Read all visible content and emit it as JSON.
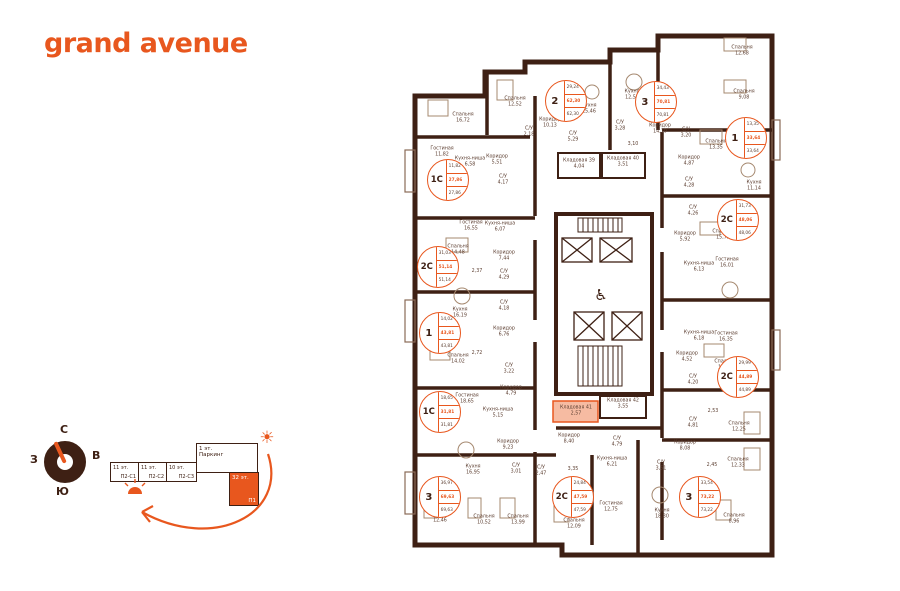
{
  "logo": {
    "text": "grand avenue"
  },
  "colors": {
    "accent": "#E8571E",
    "wall": "#3E2014",
    "room_text": "#5E4033",
    "storage_highlight": "#F6BBA2"
  },
  "compass": {
    "north": "С",
    "east": "В",
    "west": "З",
    "south": "Ю"
  },
  "section_diagram": {
    "blocks": [
      {
        "floors": "11 эт.",
        "name": "П2-С1"
      },
      {
        "floors": "11 эт.",
        "name": "П2-С2"
      },
      {
        "floors": "10 эт.",
        "name": "П2-С3"
      }
    ],
    "parking": {
      "floors": "1 эт.",
      "name": "Паркинг"
    },
    "current": {
      "floors": "32 эт.",
      "name": "П1"
    }
  },
  "plan": {
    "badges": [
      {
        "type": "1С",
        "x": 448,
        "y": 180,
        "values": [
          "11,82",
          "27,86",
          "27,86"
        ]
      },
      {
        "type": "2",
        "x": 566,
        "y": 101,
        "values": [
          "29,24",
          "62,30",
          "62,30"
        ]
      },
      {
        "type": "3",
        "x": 656,
        "y": 102,
        "values": [
          "34,43",
          "70,81",
          "70,81"
        ]
      },
      {
        "type": "1",
        "x": 746,
        "y": 138,
        "values": [
          "13,35",
          "33,64",
          "33,64"
        ]
      },
      {
        "type": "2С",
        "x": 738,
        "y": 220,
        "values": [
          "31,73",
          "48,06",
          "48,06"
        ]
      },
      {
        "type": "2С",
        "x": 438,
        "y": 267,
        "values": [
          "31,03",
          "51,14",
          "51,14"
        ]
      },
      {
        "type": "1",
        "x": 440,
        "y": 333,
        "values": [
          "14,02",
          "43,81",
          "43,81"
        ]
      },
      {
        "type": "2С",
        "x": 738,
        "y": 377,
        "values": [
          "29,99",
          "44,89",
          "44,89"
        ]
      },
      {
        "type": "1С",
        "x": 440,
        "y": 412,
        "values": [
          "18,65",
          "31,81",
          "31,81"
        ]
      },
      {
        "type": "3",
        "x": 440,
        "y": 497,
        "values": [
          "36,97",
          "69,63",
          "69,63"
        ]
      },
      {
        "type": "2С",
        "x": 573,
        "y": 497,
        "values": [
          "24,84",
          "47,59",
          "47,59"
        ]
      },
      {
        "type": "3",
        "x": 700,
        "y": 497,
        "values": [
          "33,54",
          "73,22",
          "73,22"
        ]
      }
    ],
    "rooms": [
      {
        "label": "Спальня",
        "area": "16,72",
        "x": 463,
        "y": 119
      },
      {
        "label": "Спальня",
        "area": "12,52",
        "x": 515,
        "y": 103
      },
      {
        "label": "Гостиная",
        "area": "11,82",
        "x": 442,
        "y": 153
      },
      {
        "label": "Кухня-ниша",
        "area": "6,58",
        "x": 470,
        "y": 163
      },
      {
        "label": "Коридор",
        "area": "5,51",
        "x": 497,
        "y": 161
      },
      {
        "label": "С/У",
        "area": "4,17",
        "x": 503,
        "y": 181
      },
      {
        "label": "Гостиная",
        "area": "16,55",
        "x": 471,
        "y": 227
      },
      {
        "label": "Кухня-ниша",
        "area": "6,07",
        "x": 500,
        "y": 228
      },
      {
        "label": "Спальня",
        "area": "14,48",
        "x": 458,
        "y": 251
      },
      {
        "label": "Коридор",
        "area": "7,44",
        "x": 504,
        "y": 257
      },
      {
        "label": "",
        "area": "2,37",
        "x": 477,
        "y": 272
      },
      {
        "label": "С/У",
        "area": "4,29",
        "x": 504,
        "y": 276
      },
      {
        "label": "С/У",
        "area": "4,18",
        "x": 504,
        "y": 307
      },
      {
        "label": "Кухня",
        "area": "16,19",
        "x": 460,
        "y": 314
      },
      {
        "label": "Коридор",
        "area": "6,76",
        "x": 504,
        "y": 333
      },
      {
        "label": "Спальня",
        "area": "14,02",
        "x": 458,
        "y": 360
      },
      {
        "label": "",
        "area": "2,72",
        "x": 477,
        "y": 354
      },
      {
        "label": "С/У",
        "area": "3,22",
        "x": 509,
        "y": 370
      },
      {
        "label": "Коридор",
        "area": "4,79",
        "x": 511,
        "y": 392
      },
      {
        "label": "Гостиная",
        "area": "18,65",
        "x": 467,
        "y": 400
      },
      {
        "label": "Кухня-ниша",
        "area": "5,15",
        "x": 498,
        "y": 414
      },
      {
        "label": "Коридор",
        "area": "9,23",
        "x": 508,
        "y": 446
      },
      {
        "label": "Кухня",
        "area": "16,95",
        "x": 473,
        "y": 471
      },
      {
        "label": "С/У",
        "area": "3,01",
        "x": 516,
        "y": 470
      },
      {
        "label": "С/У",
        "area": "2,47",
        "x": 541,
        "y": 472
      },
      {
        "label": "",
        "area": "3,35",
        "x": 573,
        "y": 470
      },
      {
        "label": "Спальня",
        "area": "12,46",
        "x": 440,
        "y": 519
      },
      {
        "label": "Спальня",
        "area": "10,52",
        "x": 484,
        "y": 521
      },
      {
        "label": "Спальня",
        "area": "13,99",
        "x": 518,
        "y": 521
      },
      {
        "label": "Кухня",
        "area": "15,46",
        "x": 589,
        "y": 110
      },
      {
        "label": "Коридор",
        "area": "10,13",
        "x": 550,
        "y": 124
      },
      {
        "label": "С/У",
        "area": "2,18",
        "x": 529,
        "y": 133
      },
      {
        "label": "С/У",
        "area": "5,29",
        "x": 573,
        "y": 138
      },
      {
        "label": "Кухня",
        "area": "12,51",
        "x": 632,
        "y": 96
      },
      {
        "label": "С/У",
        "area": "3,28",
        "x": 620,
        "y": 127
      },
      {
        "label": "",
        "area": "3,10",
        "x": 633,
        "y": 145
      },
      {
        "label": "Коридор",
        "area": "14,10",
        "x": 660,
        "y": 130
      },
      {
        "label": "С/У",
        "area": "3,20",
        "x": 686,
        "y": 134
      },
      {
        "label": "Кладовая 39",
        "area": "4,04",
        "x": 579,
        "y": 165
      },
      {
        "label": "Кладовая 40",
        "area": "3,51",
        "x": 623,
        "y": 163
      },
      {
        "label": "Спальня",
        "area": "12,68",
        "x": 742,
        "y": 52
      },
      {
        "label": "Спальня",
        "area": "9,08",
        "x": 744,
        "y": 96
      },
      {
        "label": "Спальня",
        "area": "13,35",
        "x": 716,
        "y": 146
      },
      {
        "label": "Кухня",
        "area": "11,14",
        "x": 754,
        "y": 187
      },
      {
        "label": "Коридор",
        "area": "4,87",
        "x": 689,
        "y": 162
      },
      {
        "label": "С/У",
        "area": "4,28",
        "x": 689,
        "y": 184
      },
      {
        "label": "С/У",
        "area": "4,26",
        "x": 693,
        "y": 212
      },
      {
        "label": "Спальня",
        "area": "15,72",
        "x": 723,
        "y": 236
      },
      {
        "label": "Гостиная",
        "area": "16,01",
        "x": 727,
        "y": 264
      },
      {
        "label": "Коридор",
        "area": "5,92",
        "x": 685,
        "y": 238
      },
      {
        "label": "Кухня-ниша",
        "area": "6,13",
        "x": 699,
        "y": 268
      },
      {
        "label": "Гостиная",
        "area": "16,35",
        "x": 726,
        "y": 338
      },
      {
        "label": "Кухня-ниша",
        "area": "6,18",
        "x": 699,
        "y": 337
      },
      {
        "label": "Коридор",
        "area": "4,52",
        "x": 687,
        "y": 358
      },
      {
        "label": "Спальня",
        "area": "13,64",
        "x": 725,
        "y": 366
      },
      {
        "label": "С/У",
        "area": "4,20",
        "x": 693,
        "y": 381
      },
      {
        "label": "",
        "area": "2,53",
        "x": 713,
        "y": 412
      },
      {
        "label": "С/У",
        "area": "4,81",
        "x": 693,
        "y": 424
      },
      {
        "label": "Спальня",
        "area": "12,25",
        "x": 739,
        "y": 428
      },
      {
        "label": "Коридор",
        "area": "8,08",
        "x": 685,
        "y": 447
      },
      {
        "label": "",
        "area": "2,45",
        "x": 712,
        "y": 466
      },
      {
        "label": "Спальня",
        "area": "12,33",
        "x": 738,
        "y": 464
      },
      {
        "label": "С/У",
        "area": "3,51",
        "x": 661,
        "y": 467
      },
      {
        "label": "Спальня",
        "area": "8,96",
        "x": 734,
        "y": 520
      },
      {
        "label": "Кухня",
        "area": "18,30",
        "x": 662,
        "y": 515
      },
      {
        "label": "Коридор",
        "area": "8,40",
        "x": 569,
        "y": 440
      },
      {
        "label": "С/У",
        "area": "4,79",
        "x": 617,
        "y": 443
      },
      {
        "label": "Кухня-ниша",
        "area": "6,21",
        "x": 612,
        "y": 463
      },
      {
        "label": "Гостиная",
        "area": "12,75",
        "x": 611,
        "y": 508
      },
      {
        "label": "Спальня",
        "area": "12,09",
        "x": 574,
        "y": 525
      },
      {
        "label": "Кладовая 41",
        "area": "2,57",
        "x": 576,
        "y": 412
      },
      {
        "label": "Кладовая 42",
        "area": "3,55",
        "x": 623,
        "y": 405
      }
    ]
  }
}
